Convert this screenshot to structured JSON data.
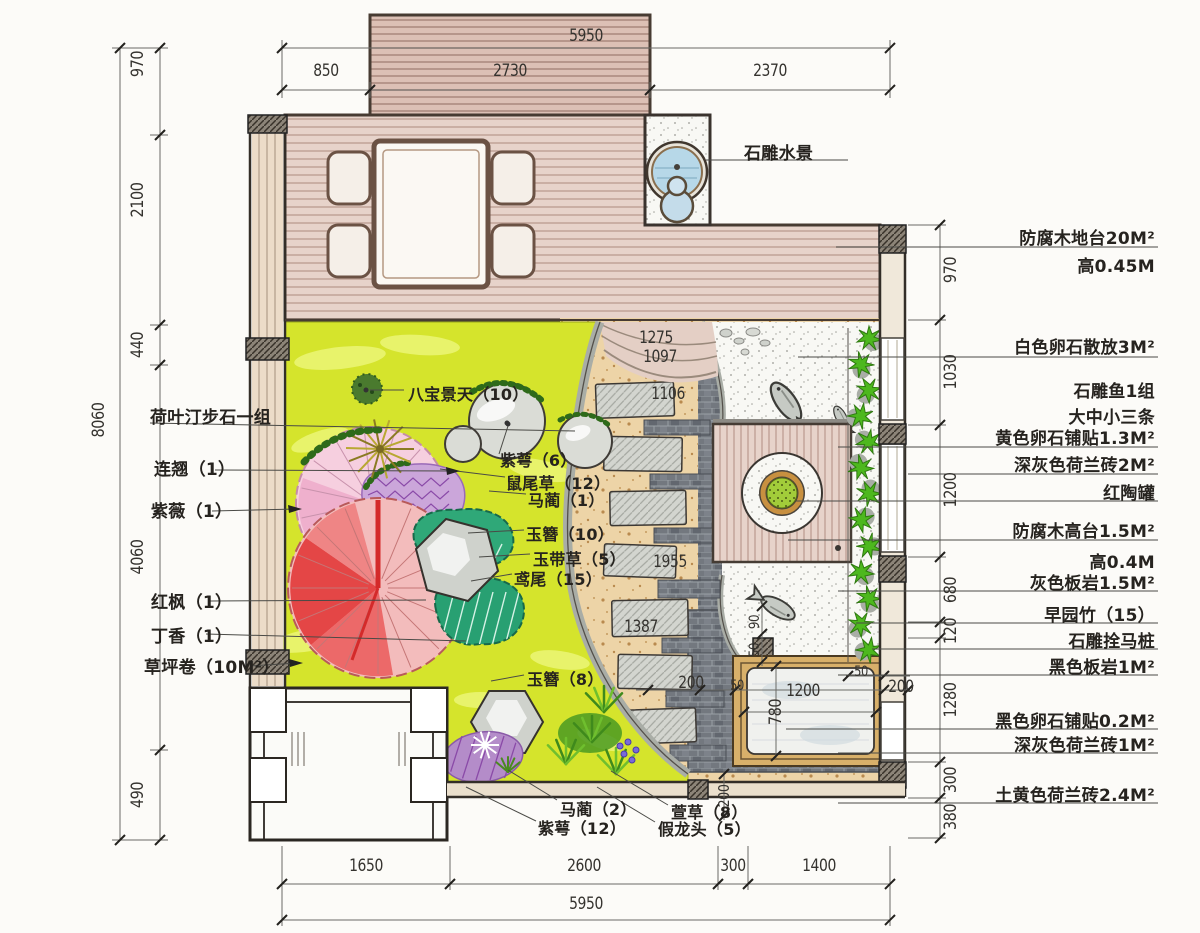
{
  "drawing_type": "residential courtyard landscape plan",
  "colors": {
    "lawn": "#d5e42c",
    "deck": "#e7d3ca",
    "bay_deck": "#dcc0b5",
    "gravel": "#edd4a7",
    "brick": "#73787f",
    "pebble_area": "#f8f8f4",
    "bamboo": "#4db81e",
    "red_maple": "#e33c3c",
    "crape_myrtle": "#f6cfdf",
    "teal_plant": "#2fa878",
    "water": "#b7d8e8",
    "pit_frame": "#d8b06a"
  },
  "dims": {
    "top": [
      {
        "text": "5950",
        "x": 586,
        "y": 36
      },
      {
        "text": "850",
        "x": 326,
        "y": 71
      },
      {
        "text": "2730",
        "x": 510,
        "y": 71
      },
      {
        "text": "2370",
        "x": 770,
        "y": 71
      }
    ],
    "bottom": [
      {
        "text": "1650",
        "x": 366,
        "y": 866
      },
      {
        "text": "2600",
        "x": 584,
        "y": 866
      },
      {
        "text": "300",
        "x": 733,
        "y": 866
      },
      {
        "text": "1400",
        "x": 819,
        "y": 866
      },
      {
        "text": "5950",
        "x": 586,
        "y": 904
      }
    ],
    "left": [
      {
        "text": "970",
        "x": 138,
        "y": 64,
        "v": 1
      },
      {
        "text": "2100",
        "x": 138,
        "y": 200,
        "v": 1
      },
      {
        "text": "440",
        "x": 138,
        "y": 345,
        "v": 1
      },
      {
        "text": "8060",
        "x": 99,
        "y": 420,
        "v": 1
      },
      {
        "text": "4060",
        "x": 138,
        "y": 557,
        "v": 1
      },
      {
        "text": "490",
        "x": 138,
        "y": 795,
        "v": 1
      }
    ],
    "right": [
      {
        "text": "970",
        "x": 951,
        "y": 270,
        "v": 1
      },
      {
        "text": "1030",
        "x": 951,
        "y": 372,
        "v": 1
      },
      {
        "text": "1200",
        "x": 951,
        "y": 490,
        "v": 1
      },
      {
        "text": "680",
        "x": 951,
        "y": 590,
        "v": 1
      },
      {
        "text": "120",
        "x": 951,
        "y": 631,
        "v": 1
      },
      {
        "text": "1280",
        "x": 951,
        "y": 700,
        "v": 1
      },
      {
        "text": "300",
        "x": 951,
        "y": 780,
        "v": 1
      },
      {
        "text": "380",
        "x": 951,
        "y": 817,
        "v": 1
      }
    ],
    "interior": [
      {
        "text": "1275",
        "x": 656,
        "y": 338
      },
      {
        "text": "1097",
        "x": 660,
        "y": 357
      },
      {
        "text": "1106",
        "x": 668,
        "y": 394
      },
      {
        "text": "1955",
        "x": 670,
        "y": 562
      },
      {
        "text": "1387",
        "x": 641,
        "y": 627
      },
      {
        "text": "200",
        "x": 691,
        "y": 683
      },
      {
        "text": "50",
        "x": 737,
        "y": 686,
        "fs": 14
      },
      {
        "text": "1200",
        "x": 803,
        "y": 691
      },
      {
        "text": "50",
        "x": 861,
        "y": 672,
        "fs": 14
      },
      {
        "text": "200",
        "x": 901,
        "y": 687
      },
      {
        "text": "780",
        "x": 776,
        "y": 712,
        "v": 1
      },
      {
        "text": "90",
        "x": 755,
        "y": 622,
        "v": 1,
        "fs": 14
      },
      {
        "text": "50",
        "x": 755,
        "y": 650,
        "v": 1,
        "fs": 14
      },
      {
        "text": "200",
        "x": 724,
        "y": 796,
        "v": 1,
        "fs": 15
      }
    ]
  },
  "labels": {
    "top": [
      {
        "text": "石雕水景",
        "x": 744,
        "y": 139,
        "n": "label-stone-water-feature"
      }
    ],
    "left": [
      {
        "text": "荷叶汀步石一组",
        "x": 150,
        "y": 403,
        "n": "label-lotus-stepping-stones"
      },
      {
        "text": "连翘（1）",
        "x": 154,
        "y": 455,
        "n": "label-forsythia"
      },
      {
        "text": "紫薇（1）",
        "x": 151,
        "y": 497,
        "n": "label-crape-myrtle"
      },
      {
        "text": "红枫（1）",
        "x": 151,
        "y": 588,
        "n": "label-red-maple"
      },
      {
        "text": "丁香（1）",
        "x": 151,
        "y": 622,
        "n": "label-lilac"
      },
      {
        "text": "草坪卷（10M²）",
        "x": 144,
        "y": 653,
        "n": "label-lawn-roll"
      }
    ],
    "right": [
      {
        "text": "防腐木地台20M²",
        "x": 1155,
        "y": 224,
        "a": "r",
        "n": "label-wood-deck-area"
      },
      {
        "text": "高0.45M",
        "x": 1155,
        "y": 252,
        "a": "r",
        "n": "label-deck-height"
      },
      {
        "text": "白色卵石散放3M²",
        "x": 1155,
        "y": 333,
        "a": "r",
        "n": "label-white-pebbles"
      },
      {
        "text": "石雕鱼1组",
        "x": 1155,
        "y": 377,
        "a": "r",
        "n": "label-stone-fish"
      },
      {
        "text": "大中小三条",
        "x": 1155,
        "y": 403,
        "a": "r",
        "n": "label-fish-sizes"
      },
      {
        "text": "黄色卵石铺贴1.3M²",
        "x": 1155,
        "y": 424,
        "a": "r",
        "n": "label-yellow-pebble-paving"
      },
      {
        "text": "深灰色荷兰砖2M²",
        "x": 1155,
        "y": 451,
        "a": "r",
        "n": "label-dark-grey-holland-brick-2"
      },
      {
        "text": "红陶罐",
        "x": 1155,
        "y": 479,
        "a": "r",
        "n": "label-red-clay-pot"
      },
      {
        "text": "防腐木高台1.5M²",
        "x": 1155,
        "y": 517,
        "a": "r",
        "n": "label-wood-platform"
      },
      {
        "text": "高0.4M",
        "x": 1155,
        "y": 548,
        "a": "r",
        "n": "label-platform-height"
      },
      {
        "text": "灰色板岩1.5M²",
        "x": 1155,
        "y": 569,
        "a": "r",
        "n": "label-grey-slate"
      },
      {
        "text": "早园竹（15）",
        "x": 1155,
        "y": 601,
        "a": "r",
        "n": "label-bamboo"
      },
      {
        "text": "石雕拴马桩",
        "x": 1155,
        "y": 627,
        "a": "r",
        "n": "label-stone-hitching-post"
      },
      {
        "text": "黑色板岩1M²",
        "x": 1155,
        "y": 653,
        "a": "r",
        "n": "label-black-slate"
      },
      {
        "text": "黑色卵石铺贴0.2M²",
        "x": 1155,
        "y": 707,
        "a": "r",
        "n": "label-black-pebble-paving"
      },
      {
        "text": "深灰色荷兰砖1M²",
        "x": 1155,
        "y": 731,
        "a": "r",
        "n": "label-dark-grey-holland-brick-1"
      },
      {
        "text": "土黄色荷兰砖2.4M²",
        "x": 1155,
        "y": 781,
        "a": "r",
        "n": "label-yellow-holland-brick"
      }
    ],
    "interior": [
      {
        "text": "八宝景天（10）",
        "x": 408,
        "y": 381,
        "n": "label-sedum"
      },
      {
        "text": "紫萼（6）",
        "x": 500,
        "y": 447,
        "n": "label-hosta-ventricosa-6"
      },
      {
        "text": "鼠尾草（12）",
        "x": 506,
        "y": 470,
        "n": "label-sage"
      },
      {
        "text": "马蔺（1）",
        "x": 528,
        "y": 487,
        "n": "label-iris-lactea-1"
      },
      {
        "text": "玉簪（10）",
        "x": 526,
        "y": 521,
        "n": "label-hosta-10"
      },
      {
        "text": "玉带草（5）",
        "x": 533,
        "y": 546,
        "n": "label-ribbon-grass"
      },
      {
        "text": "鸢尾（15）",
        "x": 514,
        "y": 566,
        "n": "label-iris-15"
      },
      {
        "text": "玉簪（8）",
        "x": 527,
        "y": 666,
        "n": "label-hosta-8"
      },
      {
        "text": "马蔺（2）",
        "x": 560,
        "y": 796,
        "n": "label-iris-lactea-2"
      },
      {
        "text": "紫萼（12）",
        "x": 538,
        "y": 815,
        "n": "label-hosta-ventricosa-12"
      },
      {
        "text": "萱草（8）",
        "x": 671,
        "y": 799,
        "n": "label-daylily"
      },
      {
        "text": "假龙头（5）",
        "x": 658,
        "y": 816,
        "n": "label-physostegia"
      }
    ]
  }
}
